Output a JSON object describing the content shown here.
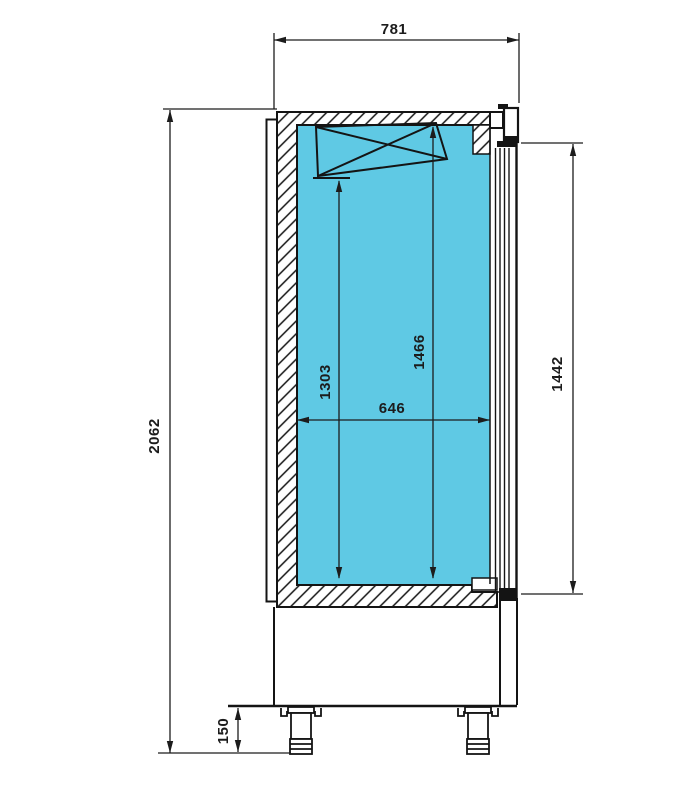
{
  "drawing": {
    "subject": "Refrigerated cabinet side-section dimension drawing",
    "background_color": "#ffffff",
    "interior_fill_color": "#5fc9e4",
    "line_color": "#141414"
  },
  "dimensions": {
    "overall_depth": "781",
    "overall_height": "2062",
    "interior_height_rear": "1303",
    "interior_height_front": "1466",
    "interior_depth": "646",
    "door_height": "1442",
    "leg_height": "150"
  }
}
